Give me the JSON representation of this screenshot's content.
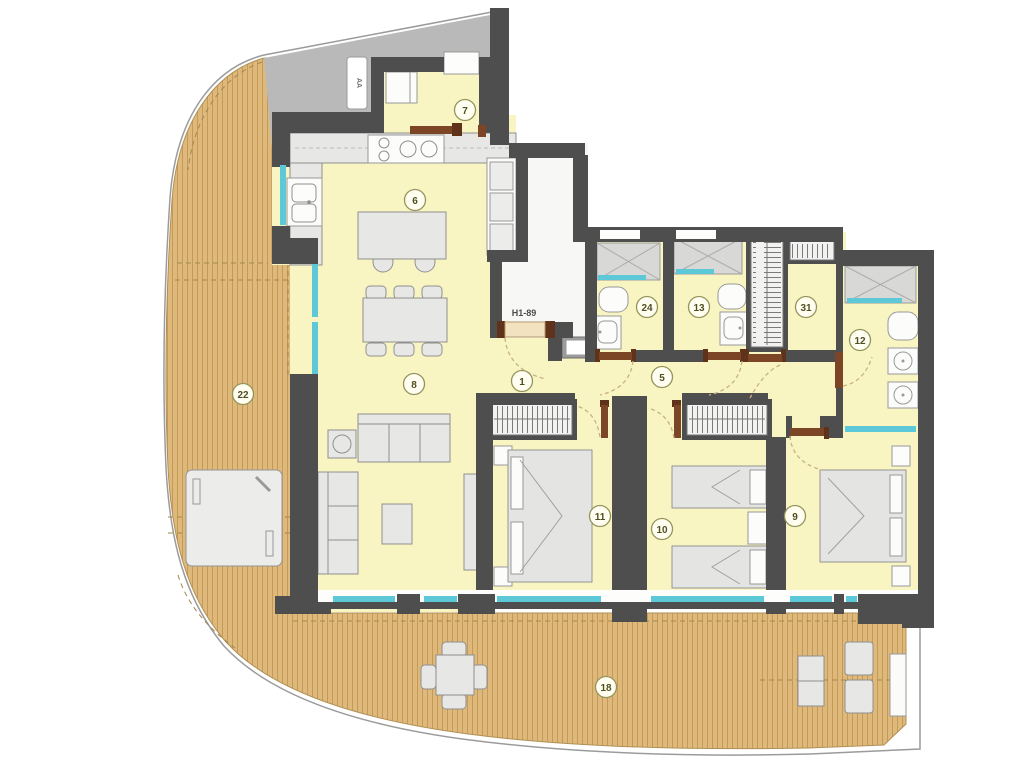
{
  "unit": {
    "label": "H1-89"
  },
  "elevator": {
    "label": "AA"
  },
  "rooms": {
    "r1": {
      "label": "1",
      "type": "hall"
    },
    "r5": {
      "label": "5",
      "type": "corridor"
    },
    "r6": {
      "label": "6",
      "type": "kitchen"
    },
    "r7": {
      "label": "7",
      "type": "laundry-entry"
    },
    "r8": {
      "label": "8",
      "type": "living-dining"
    },
    "r9": {
      "label": "9",
      "type": "bedroom"
    },
    "r10": {
      "label": "10",
      "type": "bedroom"
    },
    "r11": {
      "label": "11",
      "type": "bedroom"
    },
    "r12": {
      "label": "12",
      "type": "bathroom"
    },
    "r13": {
      "label": "13",
      "type": "bathroom"
    },
    "r18": {
      "label": "18",
      "type": "terrace"
    },
    "r22": {
      "label": "22",
      "type": "terrace"
    },
    "r24": {
      "label": "24",
      "type": "bathroom"
    },
    "r31": {
      "label": "31",
      "type": "walk-in-closet"
    }
  },
  "colors": {
    "wall": "#4e4e4e",
    "floor": "#f8f5c2",
    "common": "#b9b9b9",
    "deck": "#dfb97b",
    "deck_stripe": "#c49a58",
    "glass": "#5cc8d8",
    "door": "#7b4526",
    "furniture": "#e7e7e5",
    "label_ring": "#94945a",
    "label_text": "#4f4f24"
  }
}
